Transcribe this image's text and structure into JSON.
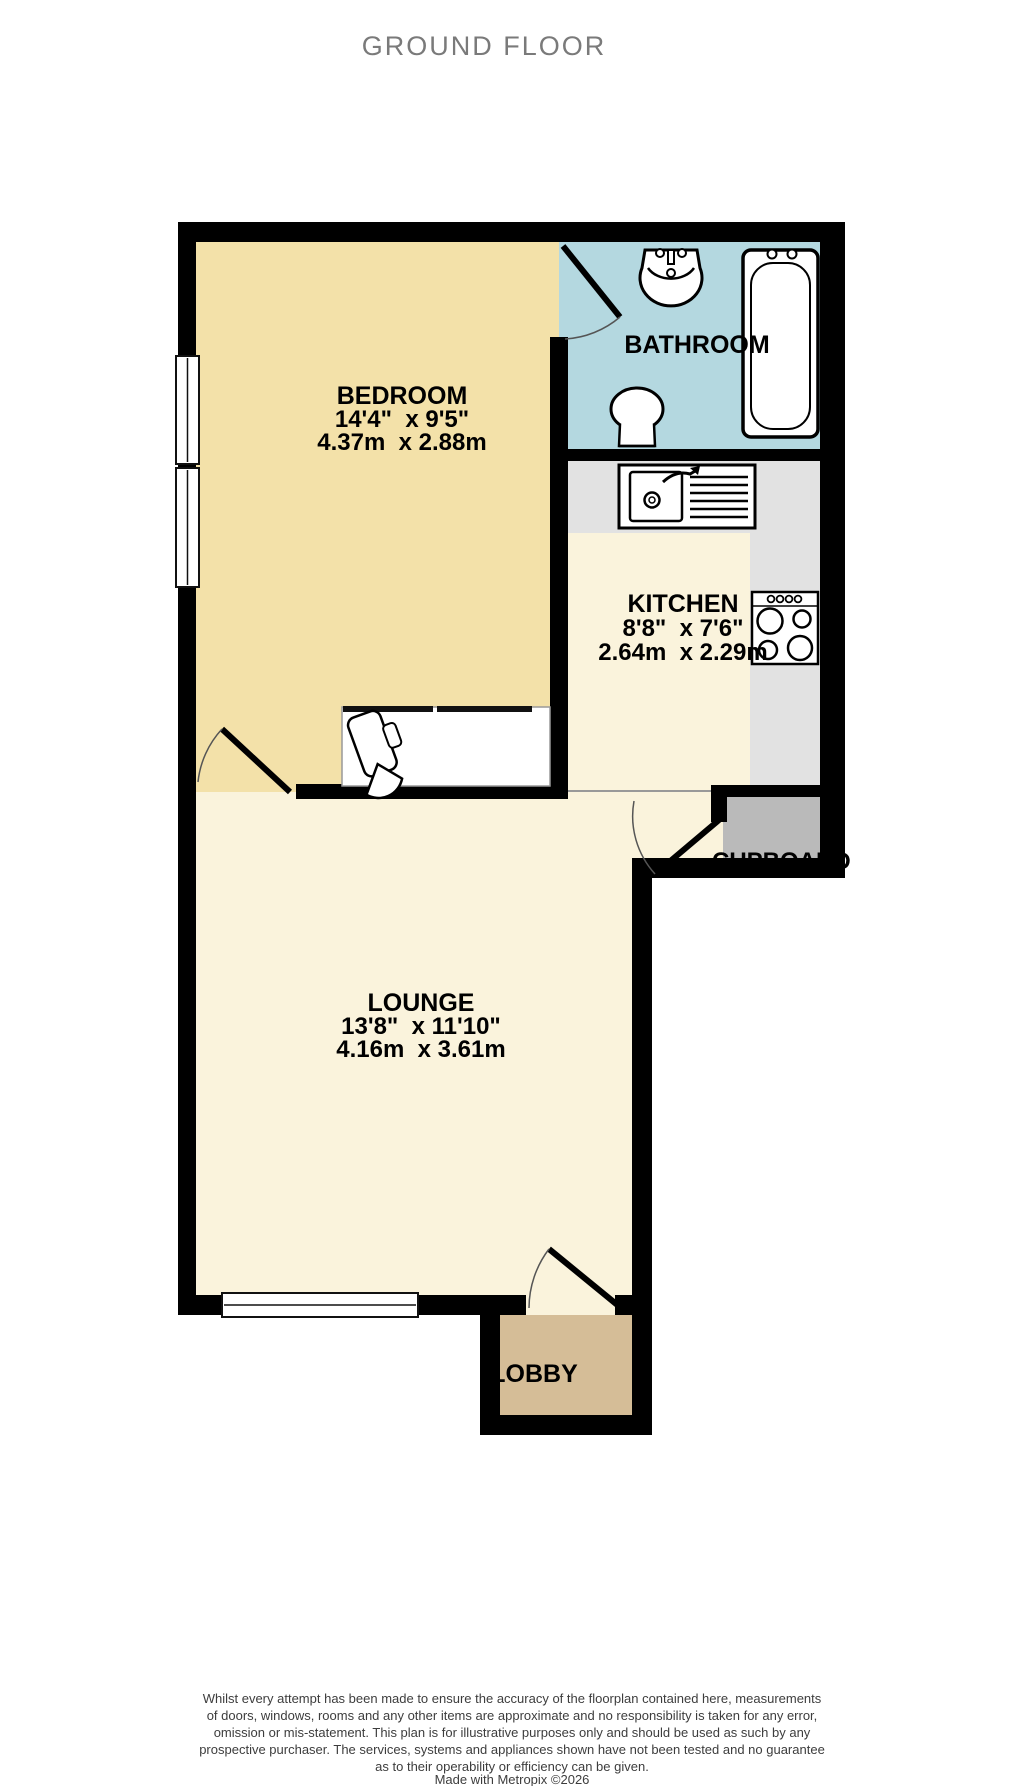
{
  "title": "GROUND FLOOR",
  "rooms": {
    "bedroom": {
      "name": "BEDROOM",
      "dims_imperial": "14'4\"  x 9'5\"",
      "dims_metric": "4.37m  x 2.88m"
    },
    "bathroom": {
      "name": "BATHROOM"
    },
    "kitchen": {
      "name": "KITCHEN",
      "dims_imperial": "8'8\"  x 7'6\"",
      "dims_metric": "2.64m  x 2.29m"
    },
    "lounge": {
      "name": "LOUNGE",
      "dims_imperial": "13'8\"  x 11'10\"",
      "dims_metric": "4.16m  x 3.61m"
    },
    "cupboard": {
      "name": "CUPBOARD"
    },
    "lobby": {
      "name": "LOBBY"
    }
  },
  "footer": {
    "disclaimer_lines": [
      "Whilst every attempt has been made to ensure the accuracy of the floorplan contained here, measurements",
      "of doors, windows, rooms and any other items are approximate and no responsibility is taken for any error,",
      "omission or mis-statement. This plan is for illustrative purposes only and should be used as such by any",
      "prospective purchaser. The services, systems and appliances shown have not been tested and no guarantee",
      "as to their operability or efficiency can be given."
    ],
    "credit": "Made with Metropix ©2026"
  },
  "colors": {
    "wall": "#000000",
    "bedroom": "#f3e1a9",
    "bathroom": "#b4d8e0",
    "kitchen": "#faf3dc",
    "lounge": "#faf3dc",
    "lobby": "#d5bd97",
    "counter": "#e2e2e2",
    "cupboard": "#bababa",
    "title_text": "#7a7a7a",
    "label_text": "#000000",
    "disclaimer_text": "#3d3d3d"
  }
}
